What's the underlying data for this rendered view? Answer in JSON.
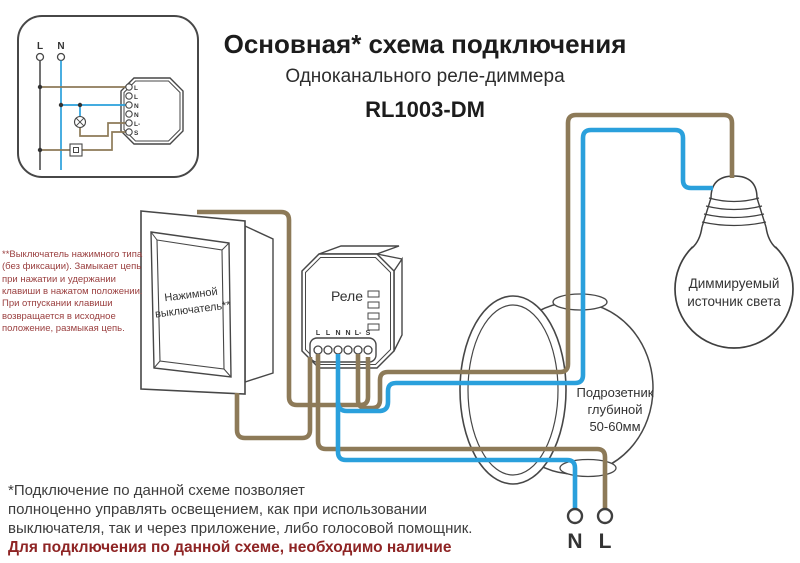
{
  "title": {
    "line1": "Основная* схема подключения",
    "line2": "Одноканального реле-диммера",
    "model": "RL1003-DM"
  },
  "inset": {
    "l_label": "L",
    "n_label": "N",
    "relay_terminals": [
      "L",
      "L",
      "N",
      "N",
      "L-",
      "S"
    ]
  },
  "switch": {
    "label": "Нажимной выключатель**"
  },
  "relay": {
    "label": "Реле",
    "terminals": [
      "L",
      "L",
      "N",
      "N",
      "L-",
      "S"
    ]
  },
  "mounting_box": {
    "label_lines": [
      "Подрозетник",
      "глубиной",
      "50-60мм"
    ]
  },
  "bulb": {
    "label": "Диммируемый источник света"
  },
  "mains": {
    "n_label": "N",
    "l_label": "L"
  },
  "switch_note": {
    "lines": [
      "**Выключатель нажимного типа",
      "(без фиксации). Замыкает цепь",
      "при нажатии и удержании",
      "клавиши в нажатом положении.",
      "При отпускании клавиши",
      "возвращается в исходное",
      "положение, размыкая цепь."
    ]
  },
  "footnote": {
    "lines": [
      "*Подключение по данной схеме позволяет",
      "полноценно управлять освещением, как при использовании",
      "выключателя, так и через приложение, либо голосовой помощник."
    ],
    "bold_lines": [
      "Для подключения по данной схеме, необходимо наличие",
      "нулевого провода в подрозетнике."
    ]
  },
  "colors": {
    "wire_live": "#8d7a58",
    "wire_neutral": "#2aa0dc",
    "outline": "#474747",
    "note_red": "#9a3f3f",
    "footnote_red": "#8e2424",
    "text_dark": "#3d3d3d"
  }
}
